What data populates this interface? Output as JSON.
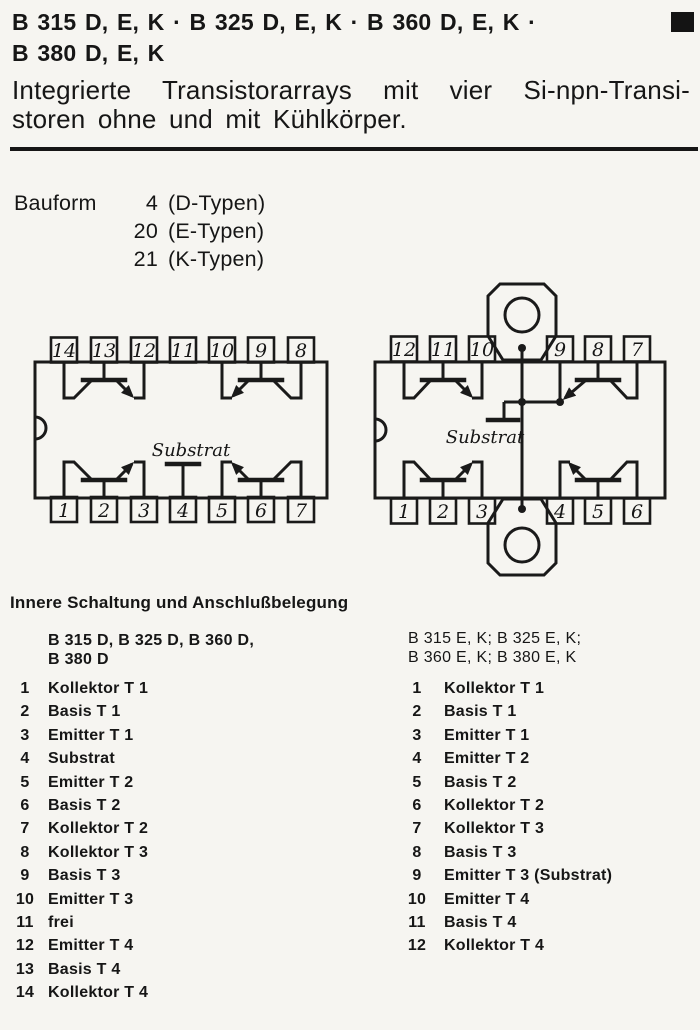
{
  "header": {
    "title_line1": "B 315 D, E, K · B 325 D, E, K · B 360 D, E, K ·",
    "title_line2": "B 380 D, E, K",
    "subtitle_line1": "Integrierte Transistorarrays mit vier Si-npn-Transi-",
    "subtitle_line2": "storen ohne und mit Kühlkörper.",
    "corner_marker_icon": "black-square",
    "ink_color": "#161616",
    "paper_color": "#f6f5f1"
  },
  "bauform": {
    "label": "Bauform",
    "rows": [
      {
        "num": "4",
        "type": "(D-Typen)"
      },
      {
        "num": "20",
        "type": "(E-Typen)"
      },
      {
        "num": "21",
        "type": "(K-Typen)"
      }
    ]
  },
  "diagrams": {
    "dip14": {
      "description": "14-pin dual-in-line package, four npn transistors, substrate on pin 4",
      "top_pins": [
        "14",
        "13",
        "12",
        "11",
        "10",
        "9",
        "8"
      ],
      "bottom_pins": [
        "1",
        "2",
        "3",
        "4",
        "5",
        "6",
        "7"
      ],
      "substrate_label": "Substrat"
    },
    "dip12": {
      "description": "12-pin package with top and bottom heatsink tabs, substrate tied to tabs and emitter T3",
      "top_pins": [
        "12",
        "11",
        "10",
        "9",
        "8",
        "7"
      ],
      "bottom_pins": [
        "1",
        "2",
        "3",
        "4",
        "5",
        "6"
      ],
      "substrate_label": "Substrat"
    }
  },
  "pinout": {
    "heading": "Innere Schaltung und Anschlußbelegung",
    "left": {
      "header_line1": "B 315 D, B 325 D, B 360 D,",
      "header_line2": "B 380 D",
      "pins": [
        {
          "num": "1",
          "label": "Kollektor T 1"
        },
        {
          "num": "2",
          "label": "Basis T 1"
        },
        {
          "num": "3",
          "label": "Emitter T 1"
        },
        {
          "num": "4",
          "label": "Substrat"
        },
        {
          "num": "5",
          "label": "Emitter T 2"
        },
        {
          "num": "6",
          "label": "Basis T 2"
        },
        {
          "num": "7",
          "label": "Kollektor T 2"
        },
        {
          "num": "8",
          "label": "Kollektor T 3"
        },
        {
          "num": "9",
          "label": "Basis T 3"
        },
        {
          "num": "10",
          "label": "Emitter T 3"
        },
        {
          "num": "11",
          "label": "frei"
        },
        {
          "num": "12",
          "label": "Emitter T 4"
        },
        {
          "num": "13",
          "label": "Basis T 4"
        },
        {
          "num": "14",
          "label": "Kollektor T 4"
        }
      ]
    },
    "right": {
      "header_line1": "B 315 E, K; B 325 E, K;",
      "header_line2": "B 360 E, K; B 380 E, K",
      "pins": [
        {
          "num": "1",
          "label": "Kollektor T 1"
        },
        {
          "num": "2",
          "label": "Basis T 1"
        },
        {
          "num": "3",
          "label": "Emitter T 1"
        },
        {
          "num": "4",
          "label": "Emitter T 2"
        },
        {
          "num": "5",
          "label": "Basis T 2"
        },
        {
          "num": "6",
          "label": "Kollektor T 2"
        },
        {
          "num": "7",
          "label": "Kollektor T 3"
        },
        {
          "num": "8",
          "label": "Basis T 3"
        },
        {
          "num": "9",
          "label": "Emitter T 3 (Substrat)"
        },
        {
          "num": "10",
          "label": "Emitter T 4"
        },
        {
          "num": "11",
          "label": "Basis T 4"
        },
        {
          "num": "12",
          "label": "Kollektor T 4"
        }
      ]
    }
  }
}
